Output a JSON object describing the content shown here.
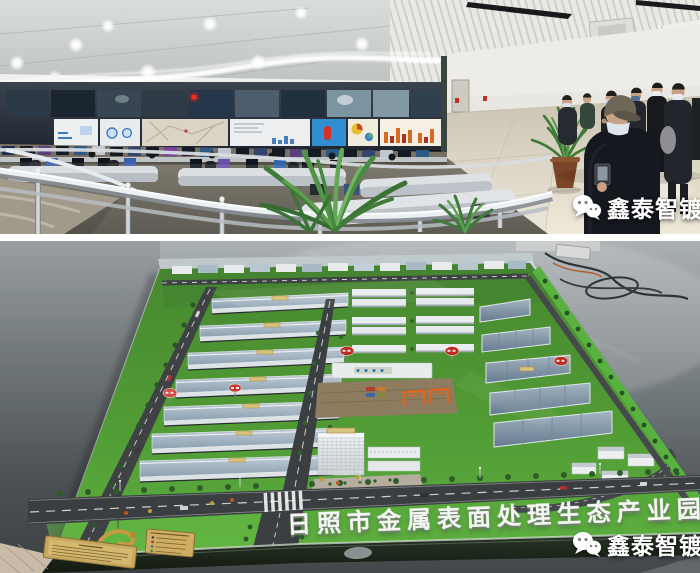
{
  "top_photo": {
    "watermark": {
      "icon": "wechat-icon",
      "text": "鑫泰智镀"
    }
  },
  "bottom_photo": {
    "model_sign_text": "日照市金属表面处理生态产业园",
    "watermark": {
      "icon": "wechat-icon",
      "text": "鑫泰智镀"
    }
  },
  "colors": {
    "watermark_text": "#ffffff",
    "lawn_green": "#52a437",
    "factory_roof_blue": "#9db0c0",
    "road_grey": "#3b3f41",
    "sign_red": "#c4281e",
    "crane_orange": "#e2641e",
    "plaque_gold": "#c9a85c",
    "floor_grey": "#5d6468",
    "ceiling_white": "#e9eae5"
  }
}
